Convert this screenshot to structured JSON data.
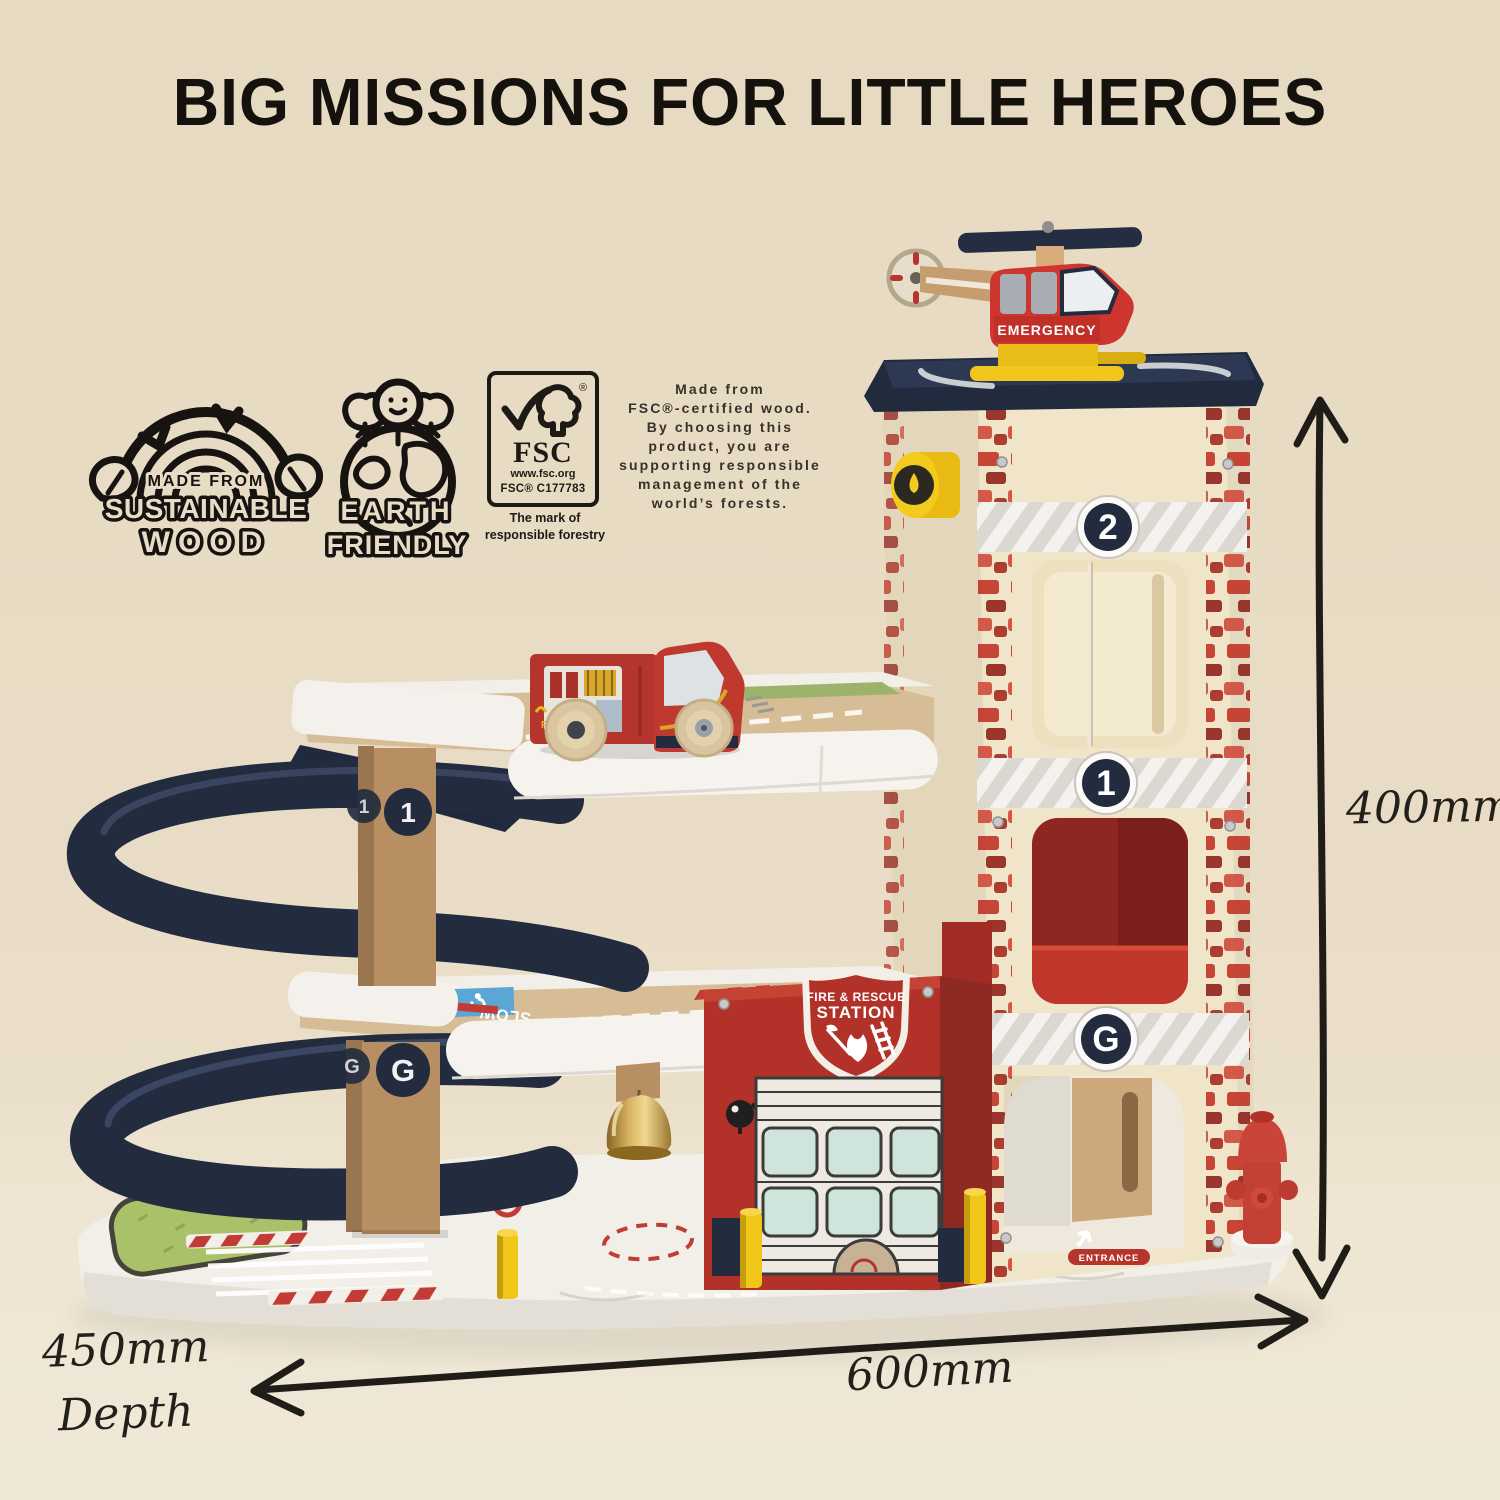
{
  "title": "BIG MISSIONS FOR LITTLE HEROES",
  "badges": {
    "sustainable": {
      "top": "MADE FROM",
      "middle": "SUSTAINABLE",
      "bottom": "WOOD"
    },
    "earth": {
      "top": "EARTH",
      "bottom": "FRIENDLY"
    },
    "fsc": {
      "reg": "®",
      "acronym": "FSC",
      "url": "www.fsc.org",
      "license": "FSC® C177783",
      "mark_line1": "The mark of",
      "mark_line2": "responsible forestry"
    }
  },
  "certification_note": {
    "lines": [
      "Made from",
      "FSC®-certified wood.",
      "By choosing this",
      "product, you are",
      "supporting responsible",
      "management of the",
      "world’s forests."
    ]
  },
  "toy": {
    "helicopter_label": "EMERGENCY",
    "station_shield": {
      "line1": "FIRE & RESCUE",
      "line2": "STATION"
    },
    "floor_labels": {
      "second": "2",
      "first": "1",
      "ground": "G"
    },
    "truck_label": "FIRE",
    "entrance_label": "ENTRANCE",
    "road_label": "SLOW"
  },
  "dimensions": {
    "height": "400mm",
    "width": "600mm",
    "depth": "450mm",
    "depth_caption": "Depth"
  },
  "colors": {
    "background": "#e9dcc6",
    "navy": "#232c3e",
    "red": "#b5342c",
    "brick_red": "#c23327",
    "cream": "#f0e5c9",
    "wood_post": "#b78f63",
    "deck": "#d6bd95",
    "yellow": "#f0c619",
    "white": "#f4f1ec",
    "brass": "#c29a4b",
    "grass_green": "#a9c168"
  }
}
